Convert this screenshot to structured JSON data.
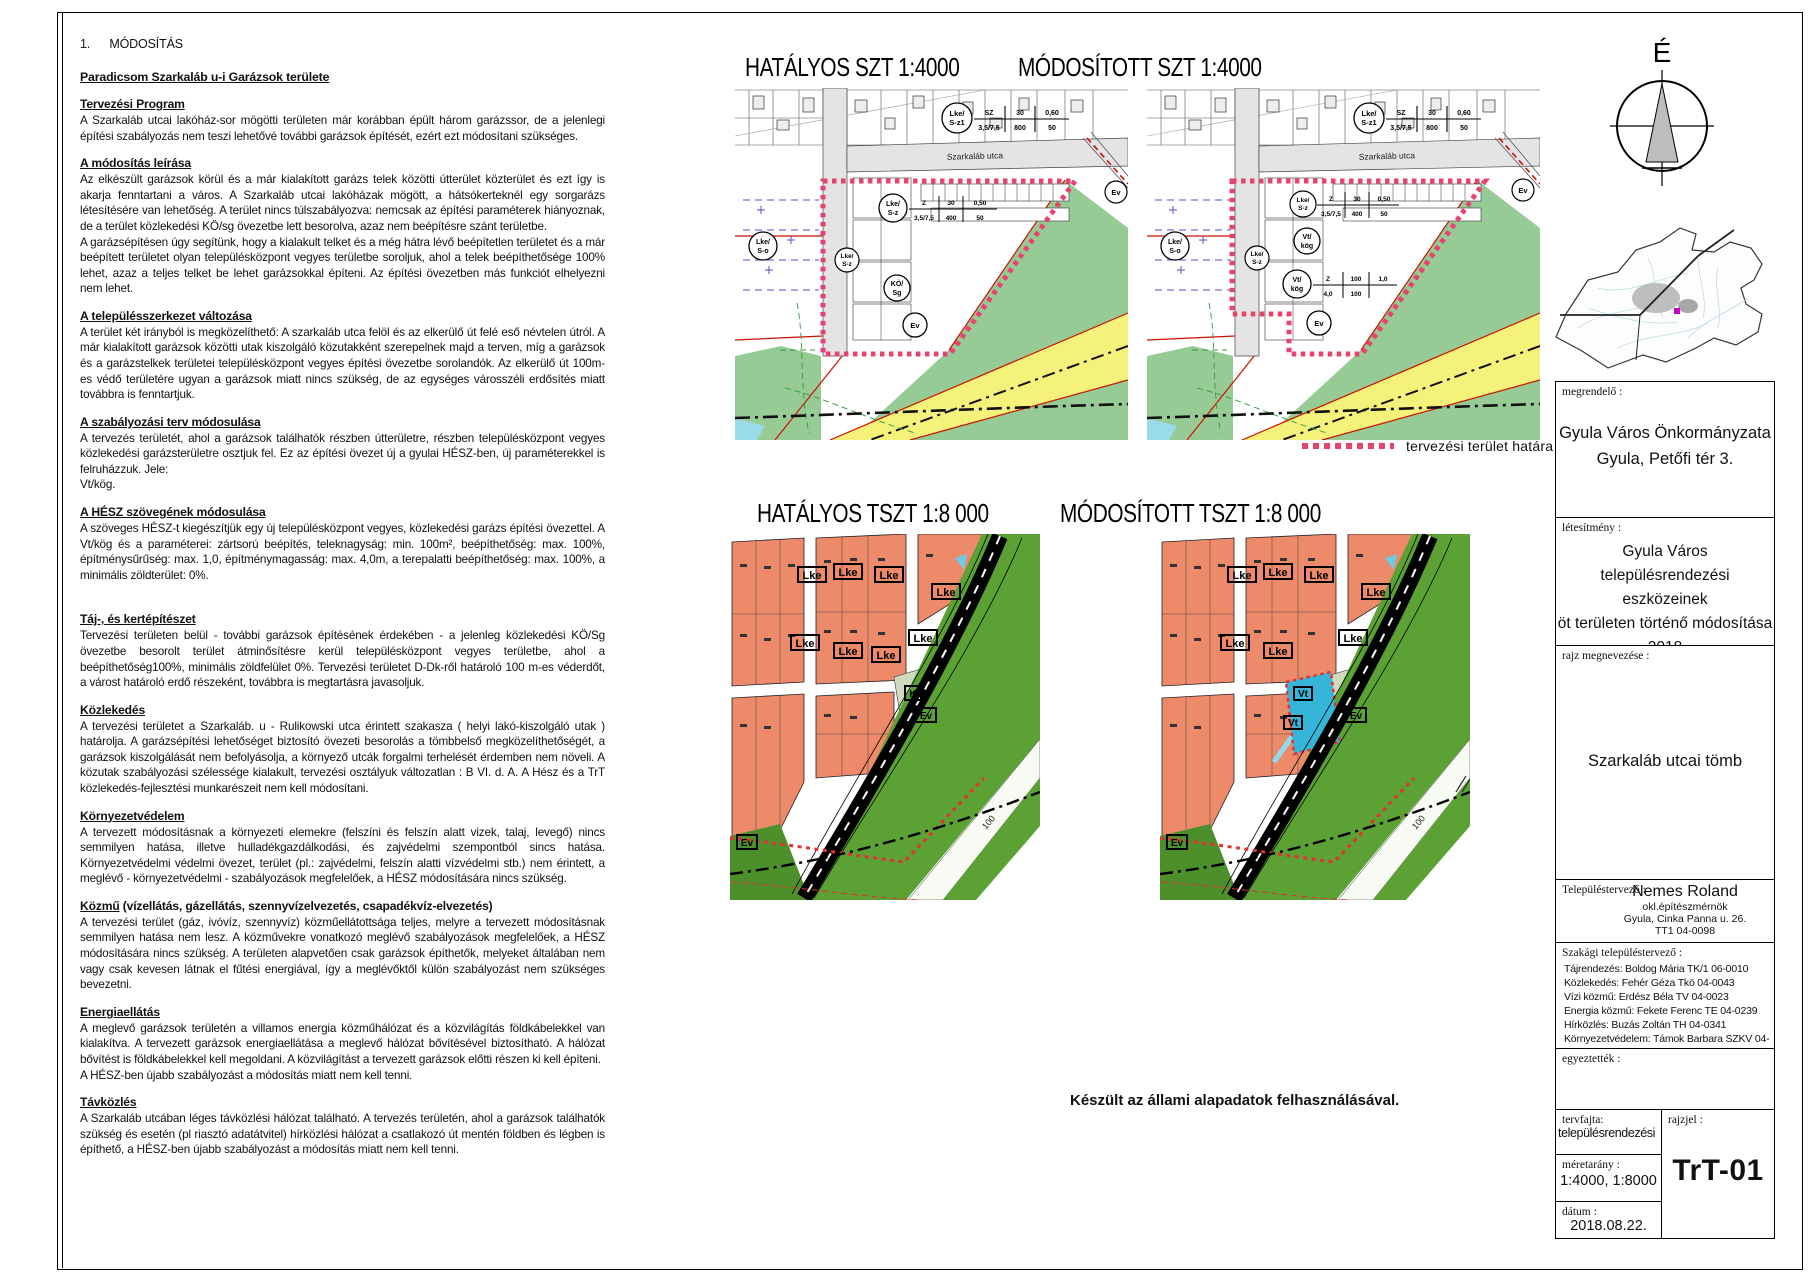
{
  "sheet": {
    "footer": "Készült az állami alapadatok felhasználásával.",
    "north_label": "É"
  },
  "report": {
    "chapter_no": "1.",
    "chapter_title": "MÓDOSÍTÁS",
    "area_title": "Paradicsom Szarkaláb u-i Garázsok területe",
    "sections": [
      {
        "heading": "Tervezési Program",
        "heading_suffix": "",
        "body": "A Szarkaláb utcai lakóház-sor mögötti területen már korábban épült három garázssor, de a jelenlegi építési szabályozás nem teszi lehetővé további garázsok építését, ezért ezt módosítani szükséges."
      },
      {
        "heading": "A módosítás leírása",
        "heading_suffix": "",
        "body": "Az elkészült garázsok körül és a már kialakított garázs telek közötti útterület közterület és ezt így is akarja fenntartani a város. A Szarkaláb utcai lakóházak mögött, a hátsókerteknél egy sorgarázs létesítésére van lehetőség. A terület nincs túlszabályozva: nemcsak az építési paraméterek hiányoznak, de a terület közlekedési KÖ/sg övezetbe lett besorolva, azaz nem beépítésre szánt területbe.\nA garázsépítésen úgy segítünk, hogy a kialakult telket és a még hátra lévő beépítetlen területet és a már beépített területet olyan településközpont vegyes területbe soroljuk, ahol a telek beépíthetősége 100% lehet, azaz a teljes telket be lehet garázsokkal építeni. Az építési övezetben más funkciót elhelyezni nem lehet."
      },
      {
        "heading": "A településszerkezet változása",
        "heading_suffix": "",
        "body": "A terület két irányból is megközelíthető: A szarkaláb utca felöl és az elkerülő út felé eső névtelen útról. A már kialakított garázsok közötti utak kiszolgáló közutakként szerepelnek majd a terven, míg a garázsok és a garázstelkek területei településközpont vegyes építési övezetbe sorolandók. Az elkerülő út 100m-es védő területére ugyan a garázsok miatt nincs szükség, de az egységes városszéli erdősítés miatt továbbra is fenntartjuk."
      },
      {
        "heading": "A szabályozási terv módosulása",
        "heading_suffix": "",
        "body": "A tervezés területét, ahol a garázsok találhatók részben útterületre, részben településközpont vegyes közlekedési garázsterületre osztjuk fel. Ez az építési övezet új a gyulai HÉSZ-ben, új paraméterekkel is felruházzuk. Jele:\nVt/kög."
      },
      {
        "heading": "A HÉSZ szövegének módosulása",
        "heading_suffix": "",
        "body": "A szöveges HÉSZ-t kiegészítjük egy új településközpont vegyes, közlekedési garázs építési övezettel. A Vt/kög és a paraméterei: zártsorú beépítés, teleknagyság: min. 100m², beépíthetőség: max. 100%, építménysűrűség: max. 1,0, építménymagasság: max. 4,0m, a terepalatti beépíthetőség: max. 100%, a minimális zöldterület: 0%."
      },
      {
        "heading": "Táj-, és kertépítészet",
        "heading_suffix": "",
        "body": "Tervezési területen belül - további garázsok építésének érdekében - a jelenleg közlekedési KÖ/Sg övezetbe besorolt terület átminősítésre kerül településközpont vegyes területbe, ahol a beépíthetőség100%, minimális zöldfelület 0%. Tervezési területet D-Dk-ről határoló 100 m-es véderdőt, a várost határoló erdő részeként, továbbra is megtartásra javasoljuk."
      },
      {
        "heading": "Közlekedés",
        "heading_suffix": "",
        "body": "A tervezési területet a Szarkaláb. u - Rulikowski utca érintett szakasza ( helyi lakó-kiszolgáló utak ) határolja. A garázsépítési lehetőséget biztosító övezeti besorolás a tömbbelső megközelíthetőségét, a garázsok kiszolgálását nem befolyásolja, a környező utcák forgalmi terhelését érdemben nem növeli. A közutak szabályozási szélessége kialakult, tervezési osztályuk változatlan : B VI. d. A. A Hész és a TrT közlekedés-fejlesztési munkarészeit nem kell módosítani."
      },
      {
        "heading": "Környezetvédelem",
        "heading_suffix": "",
        "body": "A tervezett módosításnak a környezeti elemekre (felszíni és felszín alatt vizek, talaj, levegő) nincs semmilyen hatása, illetve hulladékgazdálkodási, és zajvédelmi szempontból sincs hatása. Környezetvédelmi védelmi övezet, terület (pl.: zajvédelmi, felszín alatti vízvédelmi stb.) nem érintett, a meglévő - környezetvédelmi - szabályozások megfelelőek, a HÉSZ módosítására nincs szükség."
      },
      {
        "heading": "Közmű",
        "heading_suffix": " (vízellátás, gázellátás, szennyvízelvezetés, csapadékvíz-elvezetés)",
        "body": "A tervezési terület (gáz, ivóvíz, szennyvíz) közműellátottsága teljes, melyre a tervezett módosításnak semmilyen hatása nem lesz. A közművekre vonatkozó meglévő szabályozások megfelelőek, a HÉSZ módosítására nincs szükség. A területen alapvetően csak garázsok építhetők, melyeket általában nem vagy csak kevesen látnak el fűtési energiával, így a meglévőktől külön szabályozást nem szükséges bevezetni."
      },
      {
        "heading": "Energiaellátás",
        "heading_suffix": "",
        "body": "A meglevő garázsok területén a villamos energia közműhálózat és a közvilágítás földkábelekkel van kialakítva. A tervezett garázsok energiaellátása a meglevő hálózat bővítésével biztosítható. A hálózat bővítést is földkábelekkel kell megoldani. A közvilágítást a tervezett garázsok előtti részen ki kell építeni.\nA HÉSZ-ben újabb szabályozást a módosítás miatt nem kell tenni."
      },
      {
        "heading": "Távközlés",
        "heading_suffix": "",
        "body": "A Szarkaláb utcában léges távközlési hálózat található. A tervezés területén, ahol a garázsok találhatók szükség és esetén (pl riasztó adatátvitel) hírközlési hálózat a csatlakozó út mentén földben és légben is építhető, a HÉSZ-ben újabb szabályozást a módosítás miatt nem kell tenni."
      }
    ]
  },
  "maps": {
    "szt": {
      "title_current": "HATÁLYOS SZT  1:4000",
      "title_modified": "MÓDOSÍTOTT SZT  1:4000",
      "street": "Szarkaláb utca",
      "legend": "tervezési terület határa",
      "zone_lke": "Lke/",
      "zone_sz1": "S-z1",
      "zone_sz": "S-z",
      "zone_so": "S-o",
      "zone_ko": "KÖ/",
      "zone_sg": "Sg",
      "zone_vt": "Vt/",
      "zone_kog": "kög",
      "zone_ev": "Ev",
      "params_a": {
        "r1": [
          "SZ",
          "30",
          "0,60"
        ],
        "r2": [
          "3,5/7,5",
          "800",
          "50"
        ]
      },
      "params_b": {
        "r1": [
          "Z",
          "30",
          "0,50"
        ],
        "r2": [
          "3,5/7,5",
          "400",
          "50"
        ]
      },
      "params_vt": {
        "r1": [
          "Z",
          "100",
          "1,0"
        ],
        "r2": [
          "4,0",
          "100"
        ]
      }
    },
    "tszt": {
      "title_current": "HATÁLYOS TSZT  1:8 000",
      "title_modified": "MÓDOSÍTOTT TSZT  1:8 000",
      "zone_lke": "Lke",
      "zone_ev": "Ev",
      "zone_k": "K",
      "zone_vt": "Vt",
      "road_label": "100"
    },
    "colors": {
      "boundary_pink": "#e8426e",
      "forest_green_szt": "#97cb96",
      "forest_green_tszt": "#5ba133",
      "residential_salmon": "#ec8a6a",
      "road_yellow": "#f5f27c",
      "modified_cyan": "#35b6d9"
    }
  },
  "title_block": {
    "client_label": "megrendelő :",
    "client_line1": "Gyula Város Önkormányzata",
    "client_line2": "Gyula, Petőfi tér 3.",
    "project_label": "létesítmény :",
    "project_line1": "Gyula Város",
    "project_line2": "településrendezési eszközeinek",
    "project_line3": "öt területen történő módosítása",
    "project_line4": "2018",
    "drawing_label": "rajz megnevezése :",
    "drawing_name": "Szarkaláb utcai tömb",
    "planner_label": "Településtervező :",
    "planner_name": "Nemes Roland",
    "planner_title": "okl.építészmérnök",
    "planner_address": "Gyula, Cinka Panna u. 26.",
    "planner_reg": "TT1 04-0098",
    "specialists_label": "Szakági településtervező :",
    "spec1": "Tájrendezés: Boldog Mária TK/1 06-0010",
    "spec2": "Közlekedés: Fehér Géza Tkö 04-0043",
    "spec3": "Vízi közmű: Erdész Béla TV 04-0023",
    "spec4": "Energia közmű: Fekete Ferenc TE 04-0239",
    "spec5": "Hírközlés: Buzás Zoltán TH 04-0341",
    "spec6": "Környezetvédelem: Támok Barbara SZKV 04-421",
    "approved_label": "egyeztették :",
    "plan_type_label": "tervfajta:",
    "plan_type": "településrendezési",
    "scale_label": "méretarány :",
    "scale": "1:4000, 1:8000",
    "date_label": "dátum :",
    "date": "2018.08.22.",
    "code_label": "rajzjel :",
    "code": "TrT-01"
  }
}
